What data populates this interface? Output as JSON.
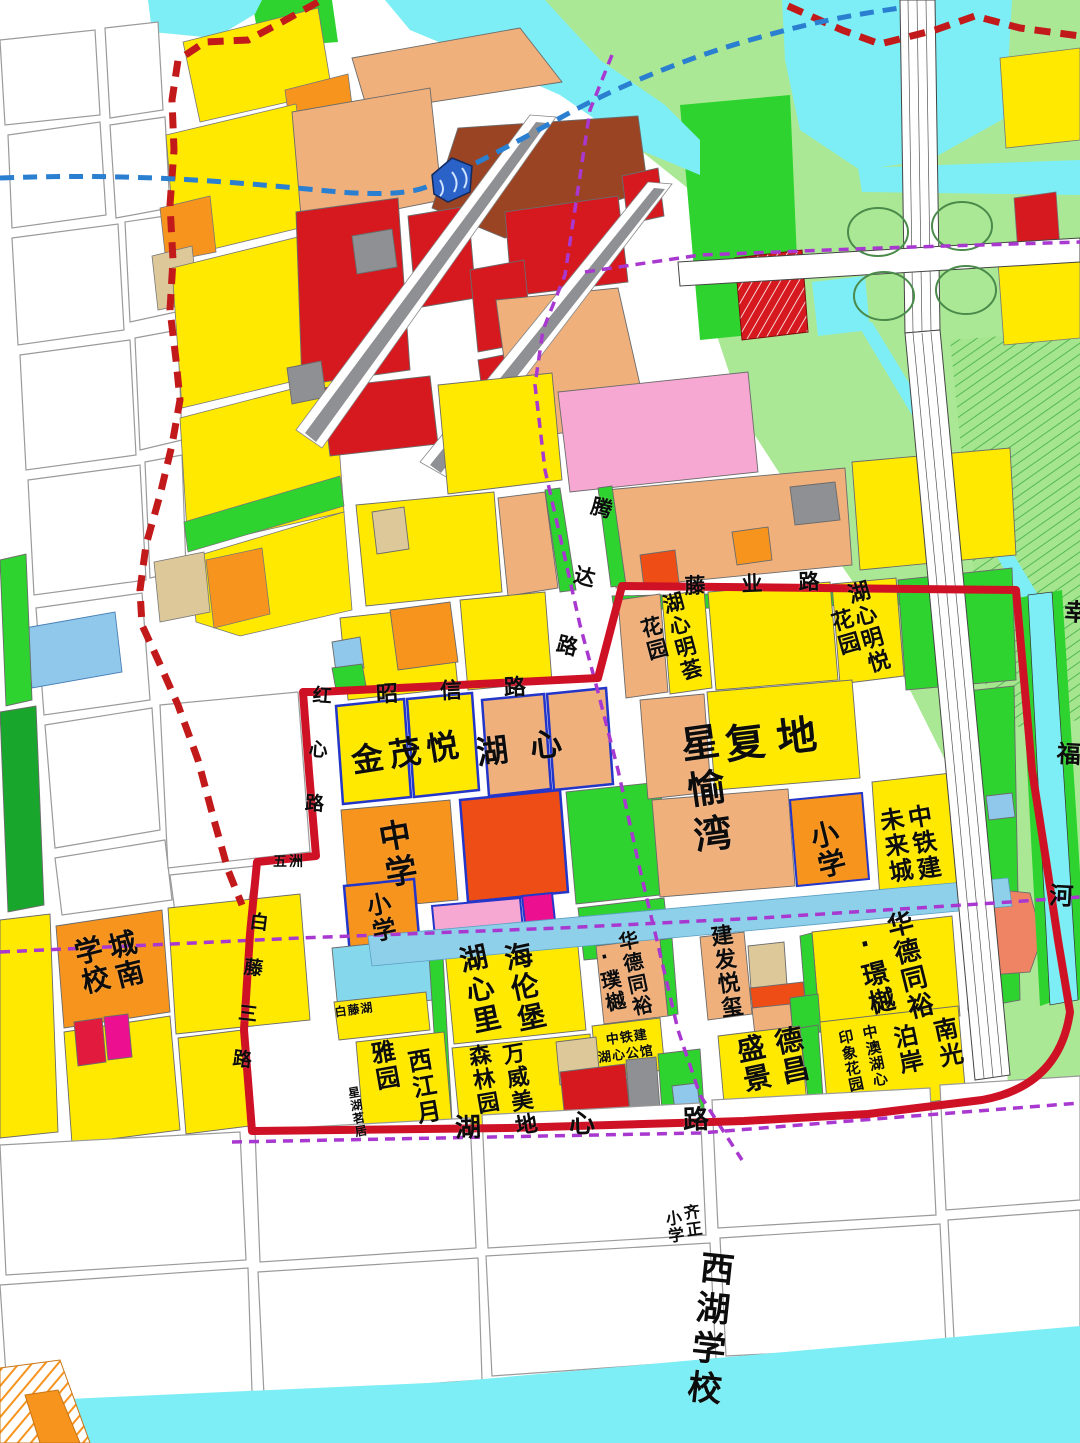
{
  "map_type": "urban-planning-zoning-map",
  "palette": {
    "residential_yellow": "#ffe900",
    "school_orange": "#f7941e",
    "residential_salmon": "#f0b07c",
    "khaki": "#ddc89a",
    "commercial_red": "#d6191f",
    "red_orange": "#ee4d16",
    "brown": "#9a4424",
    "park_green": "#2fd32f",
    "light_green": "#abe896",
    "water_cyan": "#7deef5",
    "canal_blue": "#8ed0ea",
    "parcel_blue": "#8fc8ea",
    "pink": "#f6a8d2",
    "magenta": "#ec1090",
    "gray": "#8f9093",
    "boundary_red": "#cf1126",
    "dashed_red": "#c21a1a",
    "metro_blue": "#2a7fd0",
    "dashed_purple": "#a838cf"
  },
  "roads": [
    "昭信路",
    "腾达路",
    "红心路",
    "白藤三路",
    "湖心路",
    "藤业路"
  ],
  "rivers": [
    "幸福河"
  ],
  "developments": [
    "金茂悦",
    "湖心",
    "复地星愉湾",
    "湖心明荟花园",
    "湖心明悦花园",
    "中铁建未来城",
    "海伦堡湖心里",
    "万威美地森林园",
    "西江月雅园",
    "星湖茗居",
    "白藤湖",
    "华德同裕·璞樾",
    "华德同裕·璟樾",
    "建发悦玺",
    "中铁建湖心公馆",
    "德昌盛景",
    "南光泊岸",
    "中澳湖心印象花园",
    "五洲"
  ],
  "schools": [
    "中学",
    "小学",
    "城南学校",
    "齐正小学",
    "西湖学校"
  ],
  "labels": [
    {
      "id": "jinmaoyue",
      "text": "金茂悦",
      "x": 408,
      "y": 753,
      "fs": 32,
      "rot": -9,
      "dir": "h",
      "ls": 6
    },
    {
      "id": "huxin",
      "text": "湖心",
      "x": 530,
      "y": 747,
      "fs": 32,
      "rot": -7,
      "dir": "h",
      "ls": 22
    },
    {
      "id": "fudi",
      "text": "复地",
      "x": 777,
      "y": 740,
      "fs": 40,
      "rot": -7,
      "dir": "h",
      "ls": 12
    },
    {
      "id": "xingyuwan",
      "text": "星愉湾",
      "x": 703,
      "y": 792,
      "fs": 38,
      "rot": -8,
      "dir": "v",
      "ls": 8
    },
    {
      "id": "huxinminghui",
      "text": "湖心明荟",
      "x": 681,
      "y": 637,
      "fs": 21,
      "rot": -15,
      "dir": "v",
      "ls": 2
    },
    {
      "id": "huxinminghui-garden",
      "text": "花园",
      "x": 653,
      "y": 639,
      "fs": 21,
      "rot": -15,
      "dir": "v",
      "ls": 2
    },
    {
      "id": "huxinmingyue",
      "text": "湖心明悦",
      "x": 866,
      "y": 628,
      "fs": 22,
      "rot": -16,
      "dir": "v",
      "ls": 2
    },
    {
      "id": "huxinmingyue-garden",
      "text": "花园",
      "x": 843,
      "y": 633,
      "fs": 22,
      "rot": -16,
      "dir": "v",
      "ls": 2
    },
    {
      "id": "middle-school",
      "text": "中学",
      "x": 396,
      "y": 855,
      "fs": 32,
      "rot": -10,
      "dir": "v",
      "ls": 4
    },
    {
      "id": "primary-school-west",
      "text": "小学",
      "x": 379,
      "y": 918,
      "fs": 24,
      "rot": -12,
      "dir": "v",
      "ls": 2
    },
    {
      "id": "primary-school-east",
      "text": "小学",
      "x": 826,
      "y": 850,
      "fs": 28,
      "rot": -14,
      "dir": "v",
      "ls": 2
    },
    {
      "id": "ztj-future-city-1",
      "text": "中铁建",
      "x": 922,
      "y": 843,
      "fs": 24,
      "rot": -10,
      "dir": "v",
      "ls": 2
    },
    {
      "id": "ztj-future-city-2",
      "text": "未来城",
      "x": 894,
      "y": 846,
      "fs": 24,
      "rot": -10,
      "dir": "v",
      "ls": 2
    },
    {
      "id": "helenbergh-1",
      "text": "海伦堡",
      "x": 523,
      "y": 988,
      "fs": 28,
      "rot": -12,
      "dir": "v",
      "ls": 3
    },
    {
      "id": "helenbergh-2",
      "text": "湖心里",
      "x": 478,
      "y": 990,
      "fs": 28,
      "rot": -12,
      "dir": "v",
      "ls": 3
    },
    {
      "id": "wanwei-1",
      "text": "万威美地",
      "x": 517,
      "y": 1090,
      "fs": 22,
      "rot": -10,
      "dir": "v",
      "ls": 2
    },
    {
      "id": "wanwei-2",
      "text": "森林园",
      "x": 481,
      "y": 1080,
      "fs": 22,
      "rot": -10,
      "dir": "v",
      "ls": 2
    },
    {
      "id": "xijiangyue-1",
      "text": "西江月",
      "x": 422,
      "y": 1087,
      "fs": 24,
      "rot": -10,
      "dir": "v",
      "ls": 2
    },
    {
      "id": "xijiangyue-2",
      "text": "雅园",
      "x": 383,
      "y": 1066,
      "fs": 24,
      "rot": -10,
      "dir": "v",
      "ls": 2
    },
    {
      "id": "xinghumingju",
      "text": "星湖茗居",
      "x": 357,
      "y": 1112,
      "fs": 12,
      "rot": -10,
      "dir": "v",
      "ls": 1
    },
    {
      "id": "baitenghu",
      "text": "白藤湖",
      "x": 354,
      "y": 1010,
      "fs": 12,
      "rot": -8,
      "dir": "h",
      "ls": 1
    },
    {
      "id": "huade-puyue-1",
      "text": "华德同裕",
      "x": 634,
      "y": 974,
      "fs": 20,
      "rot": -12,
      "dir": "v",
      "ls": 2
    },
    {
      "id": "huade-puyue-2",
      "text": "·璞樾",
      "x": 609,
      "y": 979,
      "fs": 20,
      "rot": -12,
      "dir": "v",
      "ls": 2
    },
    {
      "id": "huade-jingyue-1",
      "text": "华德同裕",
      "x": 908,
      "y": 966,
      "fs": 26,
      "rot": -14,
      "dir": "v",
      "ls": 2
    },
    {
      "id": "huade-jingyue-2",
      "text": "·璟樾",
      "x": 872,
      "y": 973,
      "fs": 26,
      "rot": -14,
      "dir": "v",
      "ls": 2
    },
    {
      "id": "jianfayuexi",
      "text": "建发悦玺",
      "x": 724,
      "y": 972,
      "fs": 22,
      "rot": -8,
      "dir": "v",
      "ls": 2
    },
    {
      "id": "dechang-1",
      "text": "德昌",
      "x": 790,
      "y": 1056,
      "fs": 28,
      "rot": -12,
      "dir": "v",
      "ls": 2
    },
    {
      "id": "dechang-2",
      "text": "盛景",
      "x": 752,
      "y": 1064,
      "fs": 28,
      "rot": -12,
      "dir": "v",
      "ls": 2
    },
    {
      "id": "nanguang-1",
      "text": "南光",
      "x": 946,
      "y": 1043,
      "fs": 24,
      "rot": -12,
      "dir": "v",
      "ls": 2
    },
    {
      "id": "nanguang-2",
      "text": "泊岸",
      "x": 906,
      "y": 1050,
      "fs": 24,
      "rot": -12,
      "dir": "v",
      "ls": 2
    },
    {
      "id": "zhongao-1",
      "text": "中澳湖心",
      "x": 874,
      "y": 1056,
      "fs": 15,
      "rot": -12,
      "dir": "v",
      "ls": 1
    },
    {
      "id": "zhongao-2",
      "text": "印象花园",
      "x": 850,
      "y": 1061,
      "fs": 15,
      "rot": -12,
      "dir": "v",
      "ls": 1
    },
    {
      "id": "ztj-guan-1",
      "text": "中铁建",
      "x": 627,
      "y": 1038,
      "fs": 13,
      "rot": -8,
      "dir": "h",
      "ls": 1
    },
    {
      "id": "ztj-guan-2",
      "text": "湖心公馆",
      "x": 626,
      "y": 1055,
      "fs": 13,
      "rot": -8,
      "dir": "h",
      "ls": 1
    },
    {
      "id": "chengnan-1",
      "text": "城南",
      "x": 124,
      "y": 960,
      "fs": 28,
      "rot": -14,
      "dir": "v",
      "ls": 2
    },
    {
      "id": "chengnan-2",
      "text": "学校",
      "x": 90,
      "y": 966,
      "fs": 28,
      "rot": -14,
      "dir": "v",
      "ls": 2
    },
    {
      "id": "qizheng-1",
      "text": "齐正",
      "x": 691,
      "y": 1221,
      "fs": 16,
      "rot": -8,
      "dir": "v",
      "ls": 1
    },
    {
      "id": "qizheng-2",
      "text": "小学",
      "x": 673,
      "y": 1227,
      "fs": 16,
      "rot": -8,
      "dir": "v",
      "ls": 1
    },
    {
      "id": "xihu-school",
      "text": "西湖学校",
      "x": 707,
      "y": 1330,
      "fs": 34,
      "rot": 6,
      "dir": "v",
      "ls": 6
    },
    {
      "id": "wuzhou",
      "text": "五洲",
      "x": 289,
      "y": 862,
      "fs": 14,
      "rot": 0,
      "dir": "h",
      "ls": 2
    },
    {
      "id": "road-zhaoxin",
      "text": "昭信路",
      "x": 472,
      "y": 691,
      "fs": 22,
      "rot": -3,
      "dir": "h",
      "ls": 42
    },
    {
      "id": "road-tengda",
      "text": "腾达路",
      "x": 577,
      "y": 600,
      "fs": 21,
      "rot": 14,
      "dir": "v",
      "ls": 50
    },
    {
      "id": "road-hongxin",
      "text": "红心路",
      "x": 315,
      "y": 766,
      "fs": 19,
      "rot": 4,
      "dir": "v",
      "ls": 35
    },
    {
      "id": "road-baitengsan",
      "text": "白藤三路",
      "x": 247,
      "y": 1003,
      "fs": 19,
      "rot": 7,
      "dir": "v",
      "ls": 27
    },
    {
      "id": "road-huxin",
      "text": "湖心路",
      "x": 626,
      "y": 1123,
      "fs": 26,
      "rot": -2,
      "dir": "h",
      "ls": 88
    },
    {
      "id": "road-tengye",
      "text": "藤业路",
      "x": 770,
      "y": 584,
      "fs": 21,
      "rot": -2,
      "dir": "h",
      "ls": 36
    },
    {
      "id": "river-xingfu",
      "text": "幸福河",
      "x": 1063,
      "y": 812,
      "fs": 24,
      "rot": 3,
      "dir": "v",
      "ls": 118
    }
  ]
}
